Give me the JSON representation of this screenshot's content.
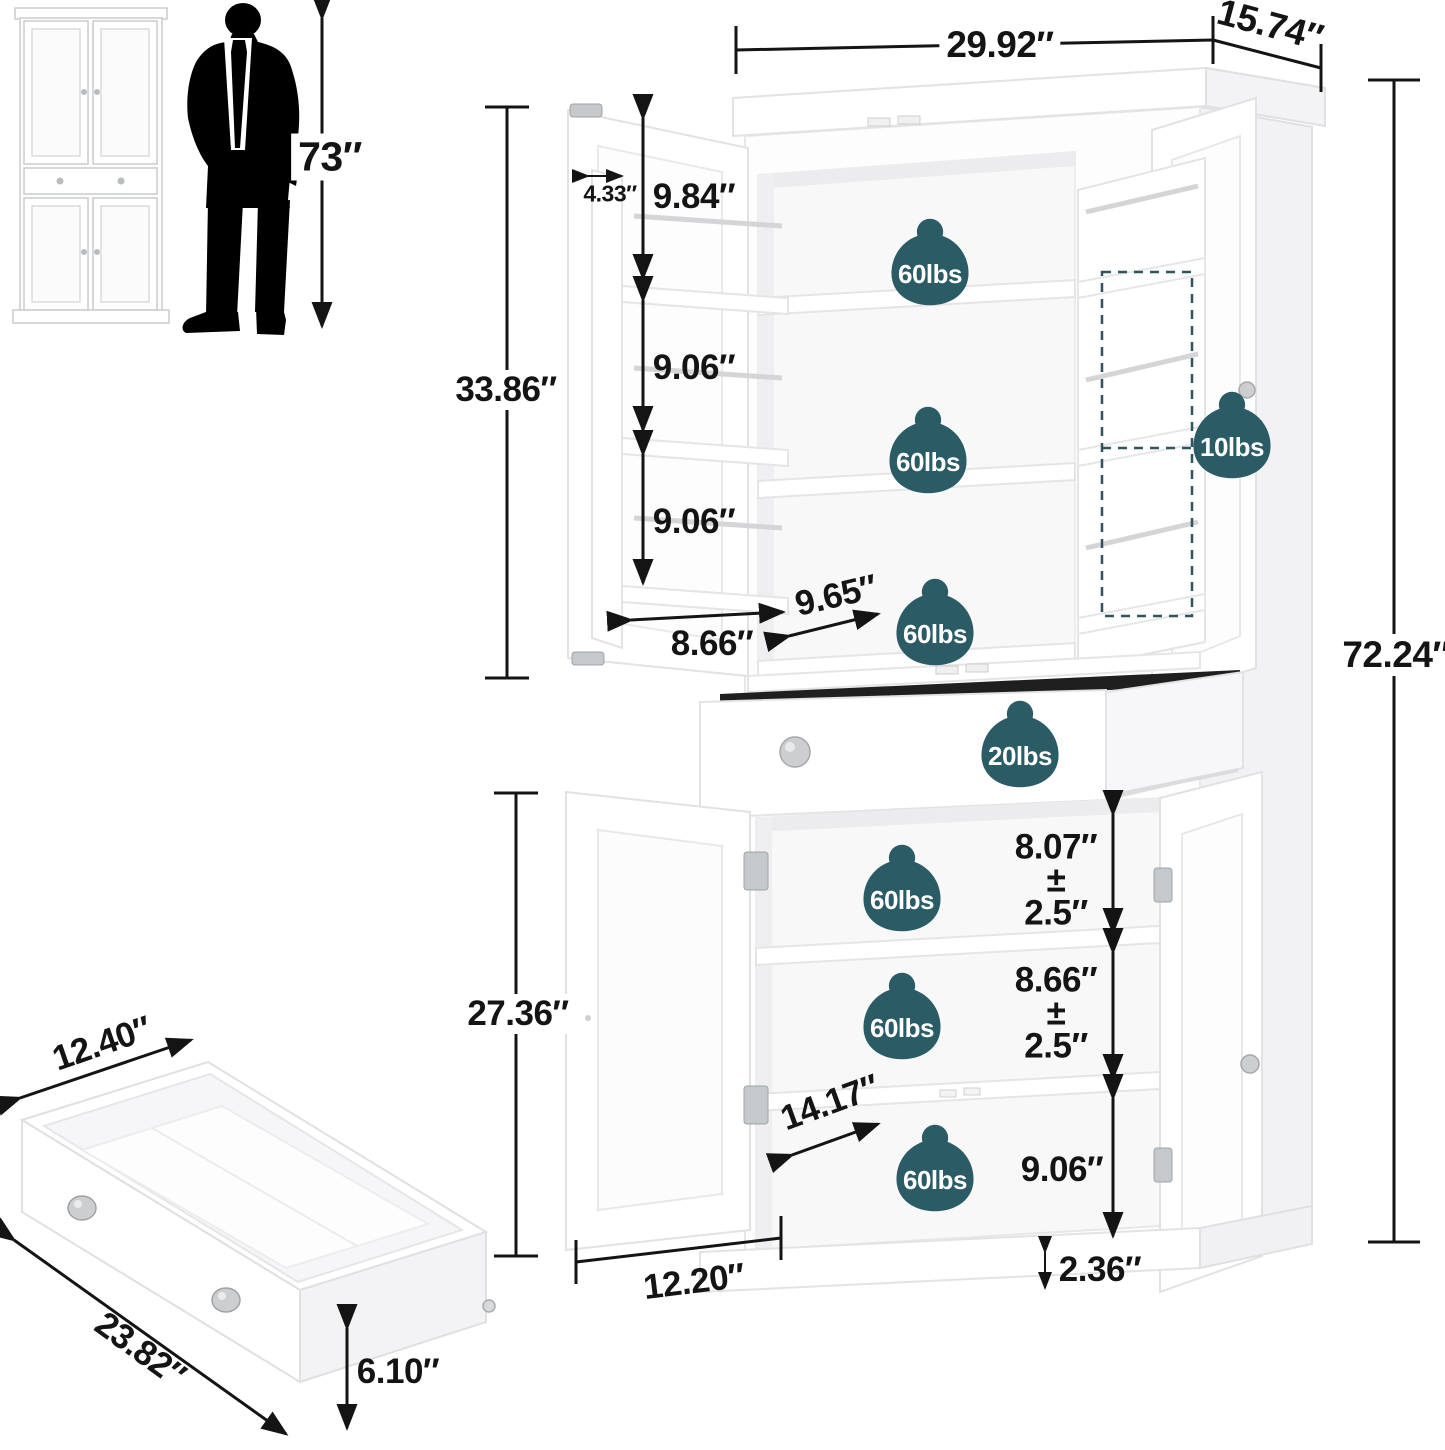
{
  "dims": {
    "overall_width": "29.92″",
    "overall_depth": "15.74″",
    "overall_height": "72.24″",
    "man_height": "73″",
    "upper_section_height": "33.86″",
    "lower_section_height": "27.36″",
    "door_shelf_depth": "4.33″",
    "upper_door_shelf_1": "9.84″",
    "upper_door_shelf_2": "9.06″",
    "upper_door_shelf_3": "9.06″",
    "upper_door_width": "8.66″",
    "upper_interior_depth": "9.65″",
    "lower_shelf_1_height": "8.07″",
    "lower_shelf_1_adjust_pm": "±",
    "lower_shelf_1_adjust": "2.5″",
    "lower_shelf_2_height": "8.66″",
    "lower_shelf_2_adjust_pm": "±",
    "lower_shelf_2_adjust": "2.5″",
    "lower_shelf_3_height": "9.06″",
    "base_height": "2.36″",
    "lower_interior_depth": "14.17″",
    "lower_door_width": "12.20″",
    "drawer_width": "12.40″",
    "drawer_length": "23.82″",
    "drawer_height": "6.10″"
  },
  "capacities": {
    "upper_shelf_1": "60lbs",
    "upper_shelf_2": "60lbs",
    "upper_shelf_3": "60lbs",
    "door_rack": "10lbs",
    "drawer": "20lbs",
    "lower_shelf_1": "60lbs",
    "lower_shelf_2": "60lbs",
    "lower_shelf_3": "60lbs"
  },
  "colors": {
    "badge_teal": "#2b5c66",
    "dimension_text": "#141414",
    "silhouette_black": "#000000",
    "cabinet_white": "#ffffff"
  }
}
